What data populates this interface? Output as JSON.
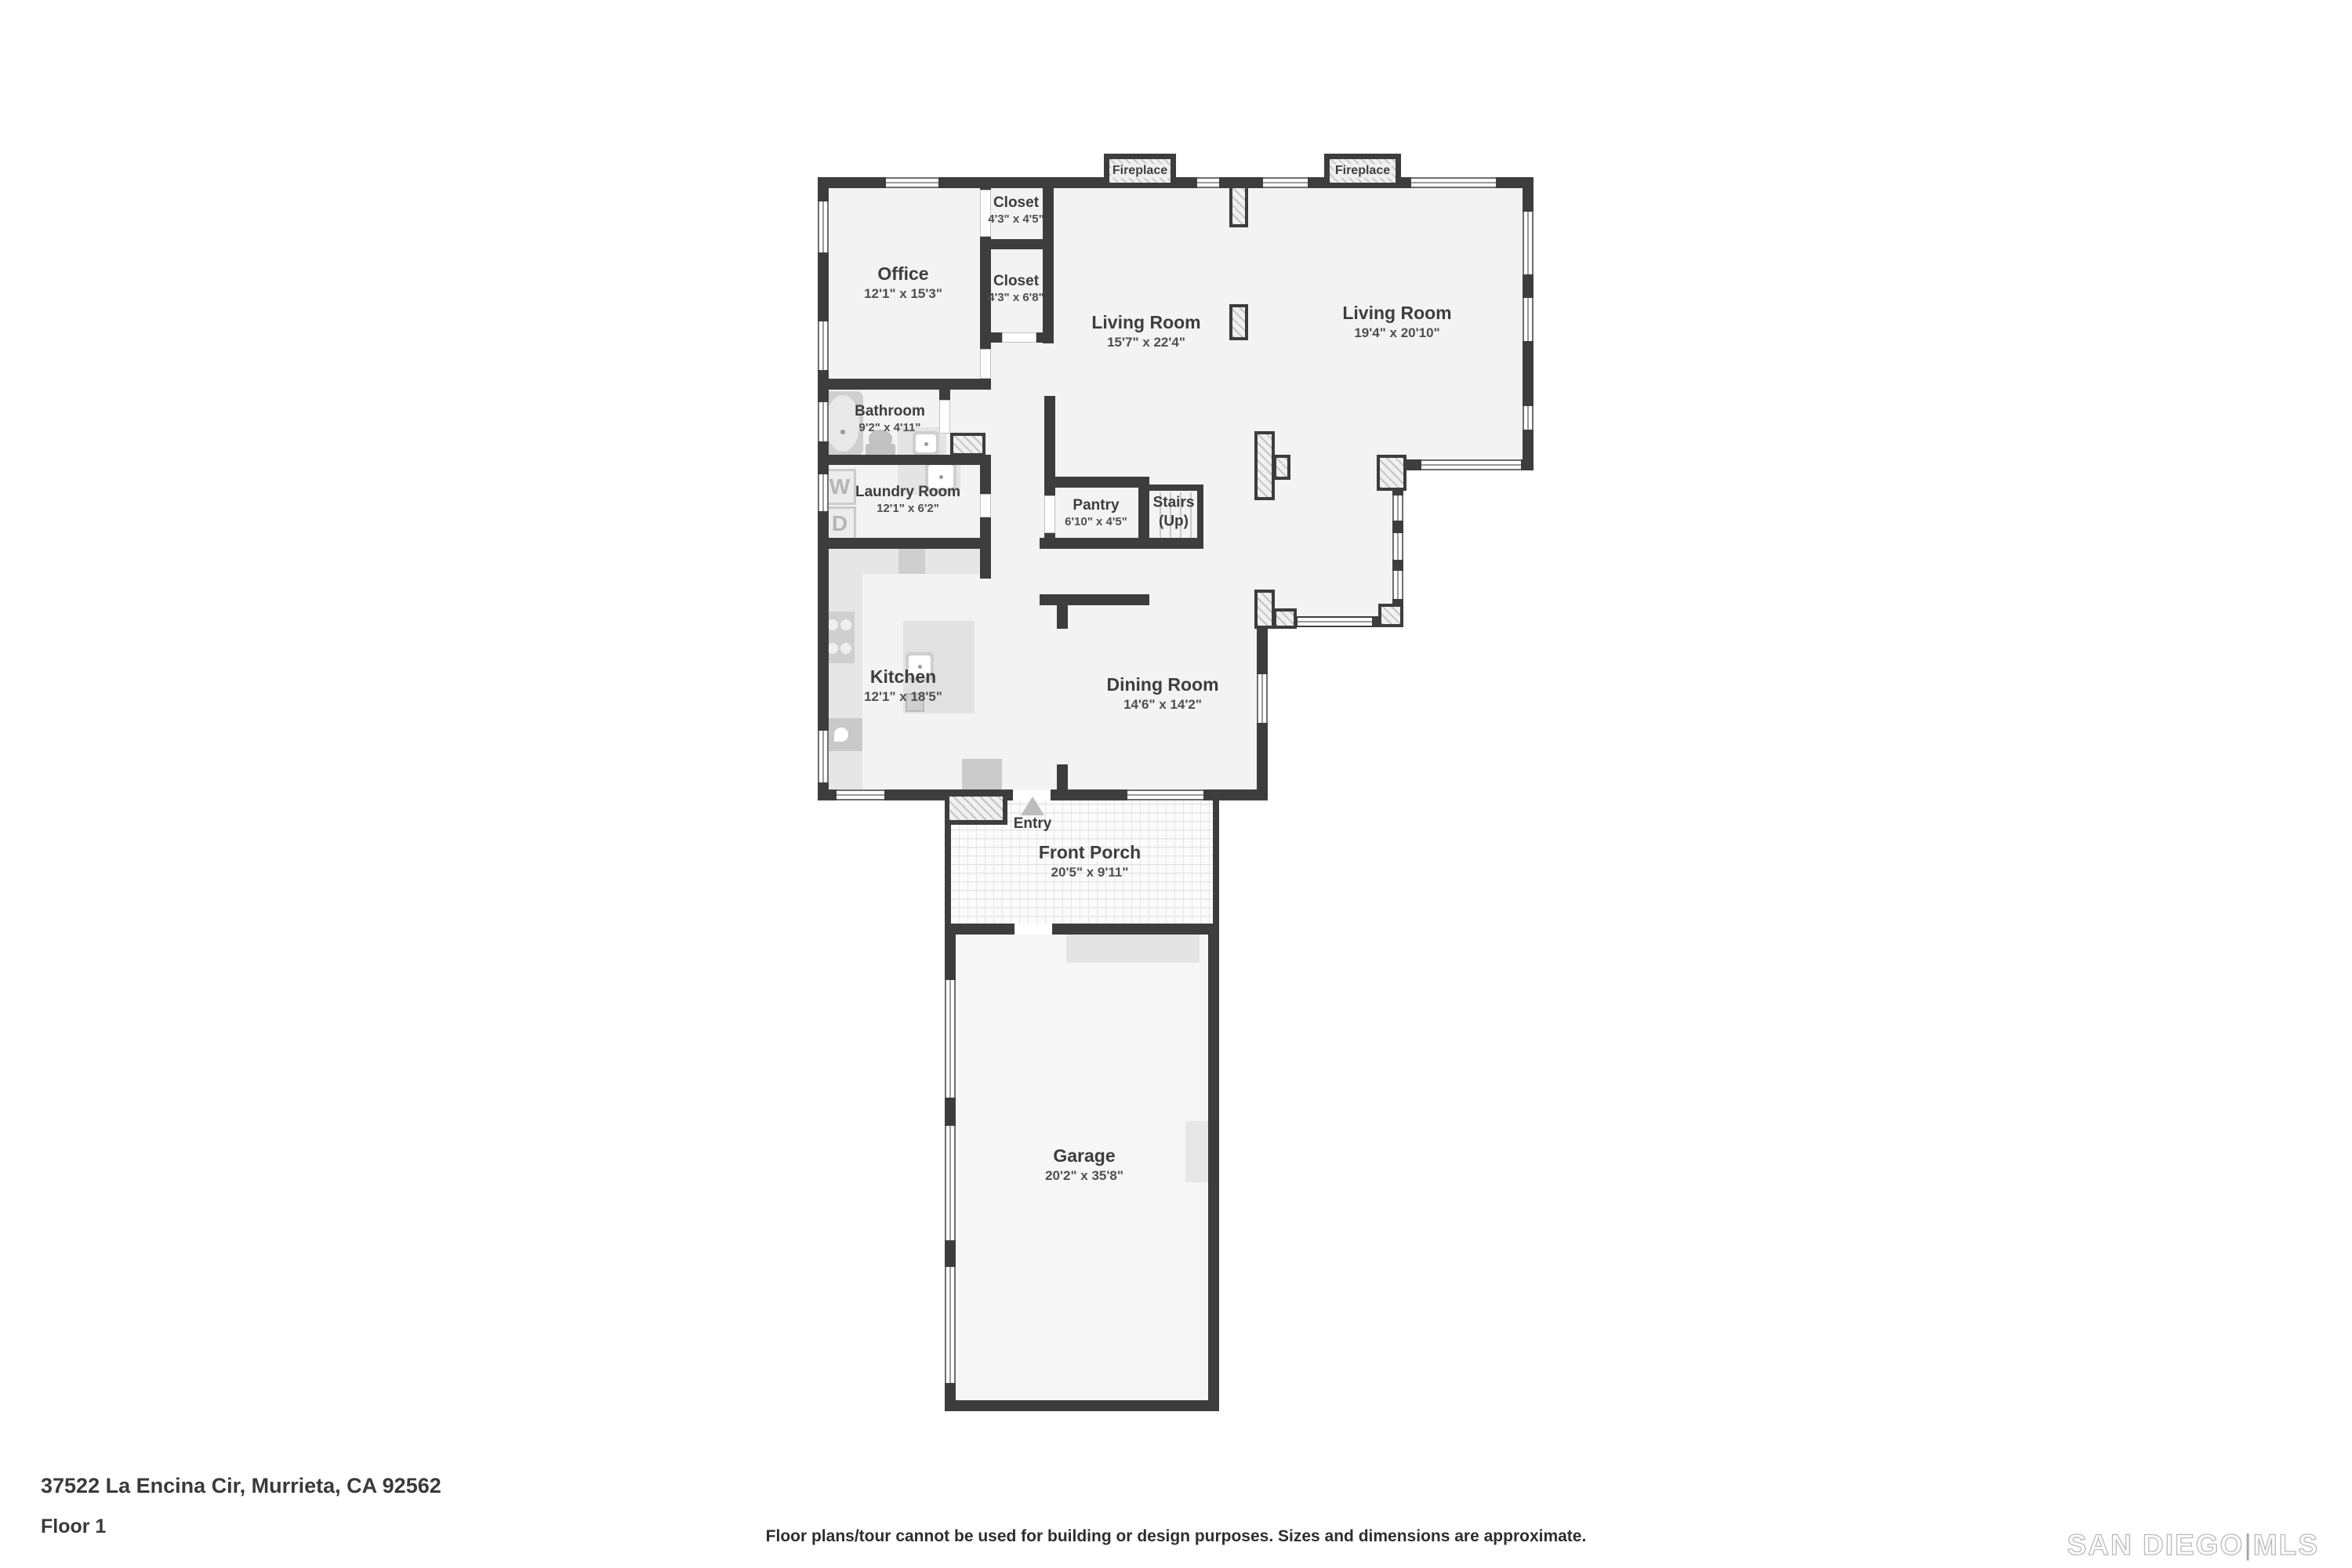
{
  "address": "37522 La Encina Cir, Murrieta, CA 92562",
  "floor_label": "Floor 1",
  "disclaimer": "Floor plans/tour cannot be used for building or design purposes. Sizes and dimensions are approximate.",
  "logo": {
    "part1": "SAN DIEGO",
    "separator": "|",
    "part2": "MLS"
  },
  "colors": {
    "wall": "#3d3d3d",
    "floor": "#f3f3f3",
    "label": "#3d3d3d"
  },
  "fireplaces": [
    {
      "label": "Fireplace"
    },
    {
      "label": "Fireplace"
    }
  ],
  "laundry": {
    "washer_label": "W",
    "dryer_label": "D"
  },
  "rooms": [
    {
      "id": "office",
      "name": "Office",
      "dims": "12'1\" x 15'3\""
    },
    {
      "id": "closet-1",
      "name": "Closet",
      "dims": "4'3\" x 4'5\""
    },
    {
      "id": "closet-2",
      "name": "Closet",
      "dims": "4'3\" x 6'8\""
    },
    {
      "id": "living-room-1",
      "name": "Living Room",
      "dims": "15'7\" x 22'4\""
    },
    {
      "id": "living-room-2",
      "name": "Living Room",
      "dims": "19'4\" x 20'10\""
    },
    {
      "id": "bathroom",
      "name": "Bathroom",
      "dims": "9'2\" x 4'11\""
    },
    {
      "id": "laundry-room",
      "name": "Laundry Room",
      "dims": "12'1\" x 6'2\""
    },
    {
      "id": "pantry",
      "name": "Pantry",
      "dims": "6'10\" x 4'5\""
    },
    {
      "id": "stairs",
      "name": "Stairs",
      "dims": "(Up)"
    },
    {
      "id": "kitchen",
      "name": "Kitchen",
      "dims": "12'1\" x 18'5\""
    },
    {
      "id": "dining-room",
      "name": "Dining Room",
      "dims": "14'6\" x 14'2\""
    },
    {
      "id": "entry",
      "name": "Entry",
      "dims": ""
    },
    {
      "id": "front-porch",
      "name": "Front Porch",
      "dims": "20'5\" x 9'11\""
    },
    {
      "id": "garage",
      "name": "Garage",
      "dims": "20'2\" x 35'8\""
    }
  ]
}
